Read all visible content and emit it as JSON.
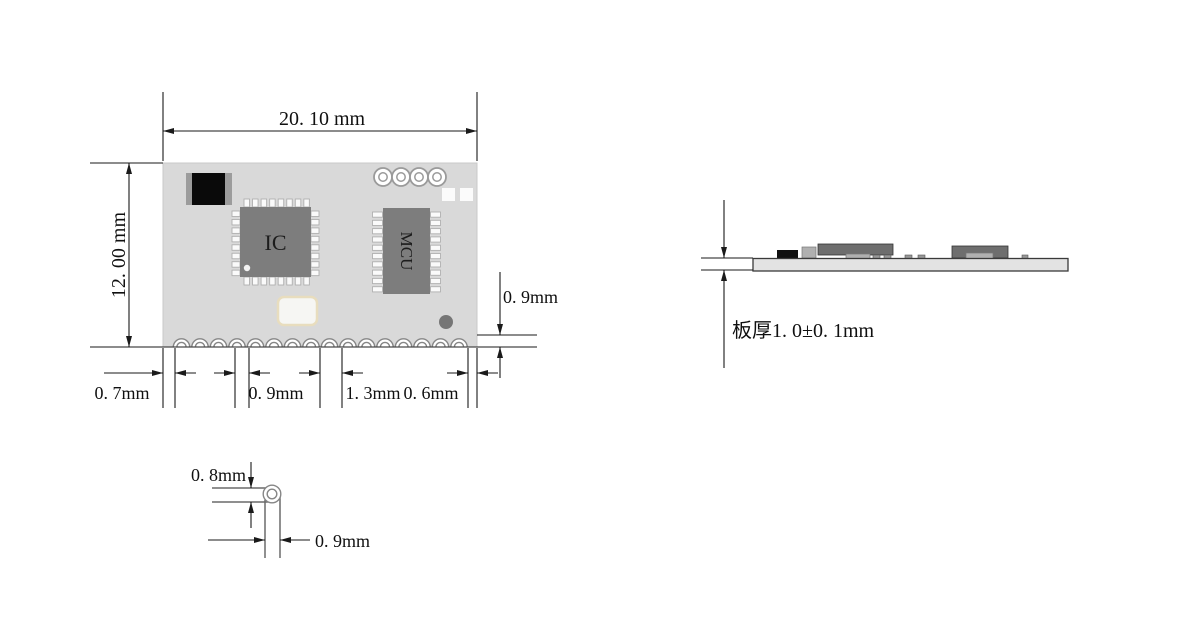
{
  "drawing": {
    "top_view": {
      "width_dim": "20. 10 mm",
      "height_dim": "12. 00 mm",
      "ic_label": "IC",
      "mcu_label": "MCU",
      "castellation_count": 16,
      "ic_pins_per_side": 8,
      "mcu_pins_per_side": 10,
      "mounting_hole_count": 4,
      "edge_dims": {
        "left_margin": "0. 7mm",
        "hole_width": "0. 9mm",
        "pitch": "1. 3mm",
        "right_margin": "0. 6mm",
        "hole_height": "0. 9mm"
      }
    },
    "pad_detail": {
      "pad_height": "0. 8mm",
      "pad_width": "0. 9mm"
    },
    "side_view": {
      "thickness": "板厚1. 0±0. 1mm"
    },
    "colors": {
      "board_fill": "#d9d9d9",
      "chip_fill": "#7d7d7d",
      "pin_fill": "#fafafa",
      "hole_stroke": "#868686",
      "dim_line": "#1a1a1a",
      "pad_line": "#6a6a6a",
      "crystal_border": "#e8ddbe",
      "via_fill": "#767676",
      "side_board_fill": "#e3e3e3",
      "comp_dark": "#6e6e6e",
      "comp_black": "#111111",
      "comp_light": "#b0b0b0"
    }
  }
}
